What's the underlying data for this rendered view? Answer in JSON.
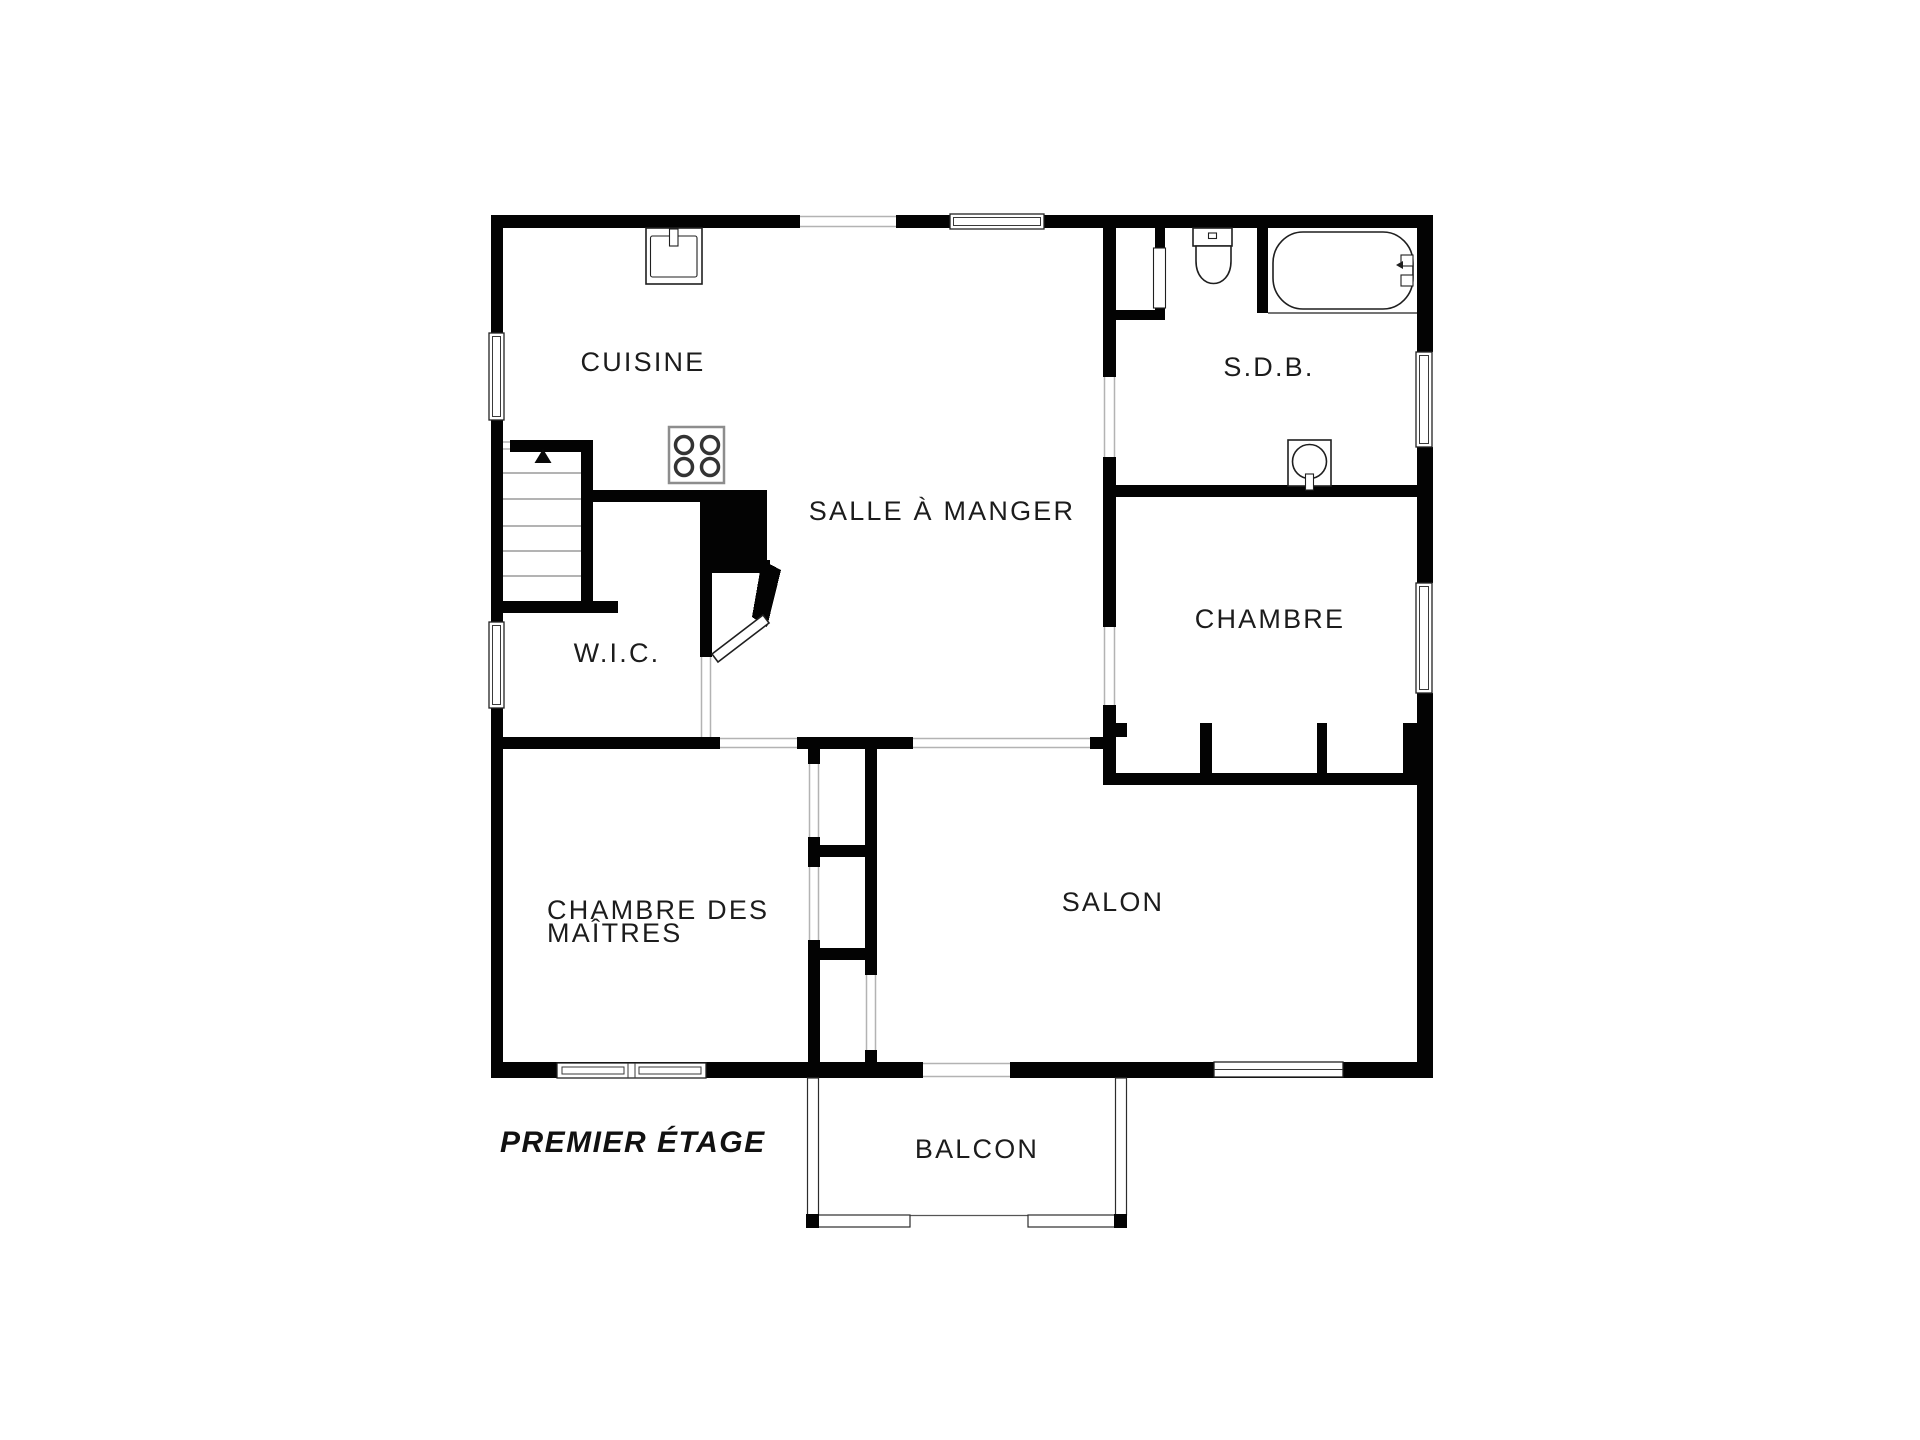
{
  "title": {
    "floor_label": "PREMIER ÉTAGE"
  },
  "rooms": {
    "cuisine": {
      "label": "CUISINE"
    },
    "salle_a_manger": {
      "label": "SALLE À MANGER"
    },
    "sdb": {
      "label": "S.D.B."
    },
    "chambre": {
      "label": "CHAMBRE"
    },
    "wic": {
      "label": "W.I.C."
    },
    "chambre_des_maitres": {
      "line1": "CHAMBRE DES",
      "line2": "MAÎTRES"
    },
    "salon": {
      "label": "SALON"
    },
    "balcon": {
      "label": "BALCON"
    }
  },
  "fixtures": {
    "kitchen_sink": "evier",
    "stove": "cuisiniere-4-feux",
    "toilet": "wc",
    "bathtub": "baignoire",
    "vanity_sink": "lavabo",
    "stairs": "escalier-montant"
  },
  "colors": {
    "wall": "#030303",
    "background": "#ffffff",
    "opening_line": "#b3b3b3",
    "text": "#1c1c1c"
  }
}
